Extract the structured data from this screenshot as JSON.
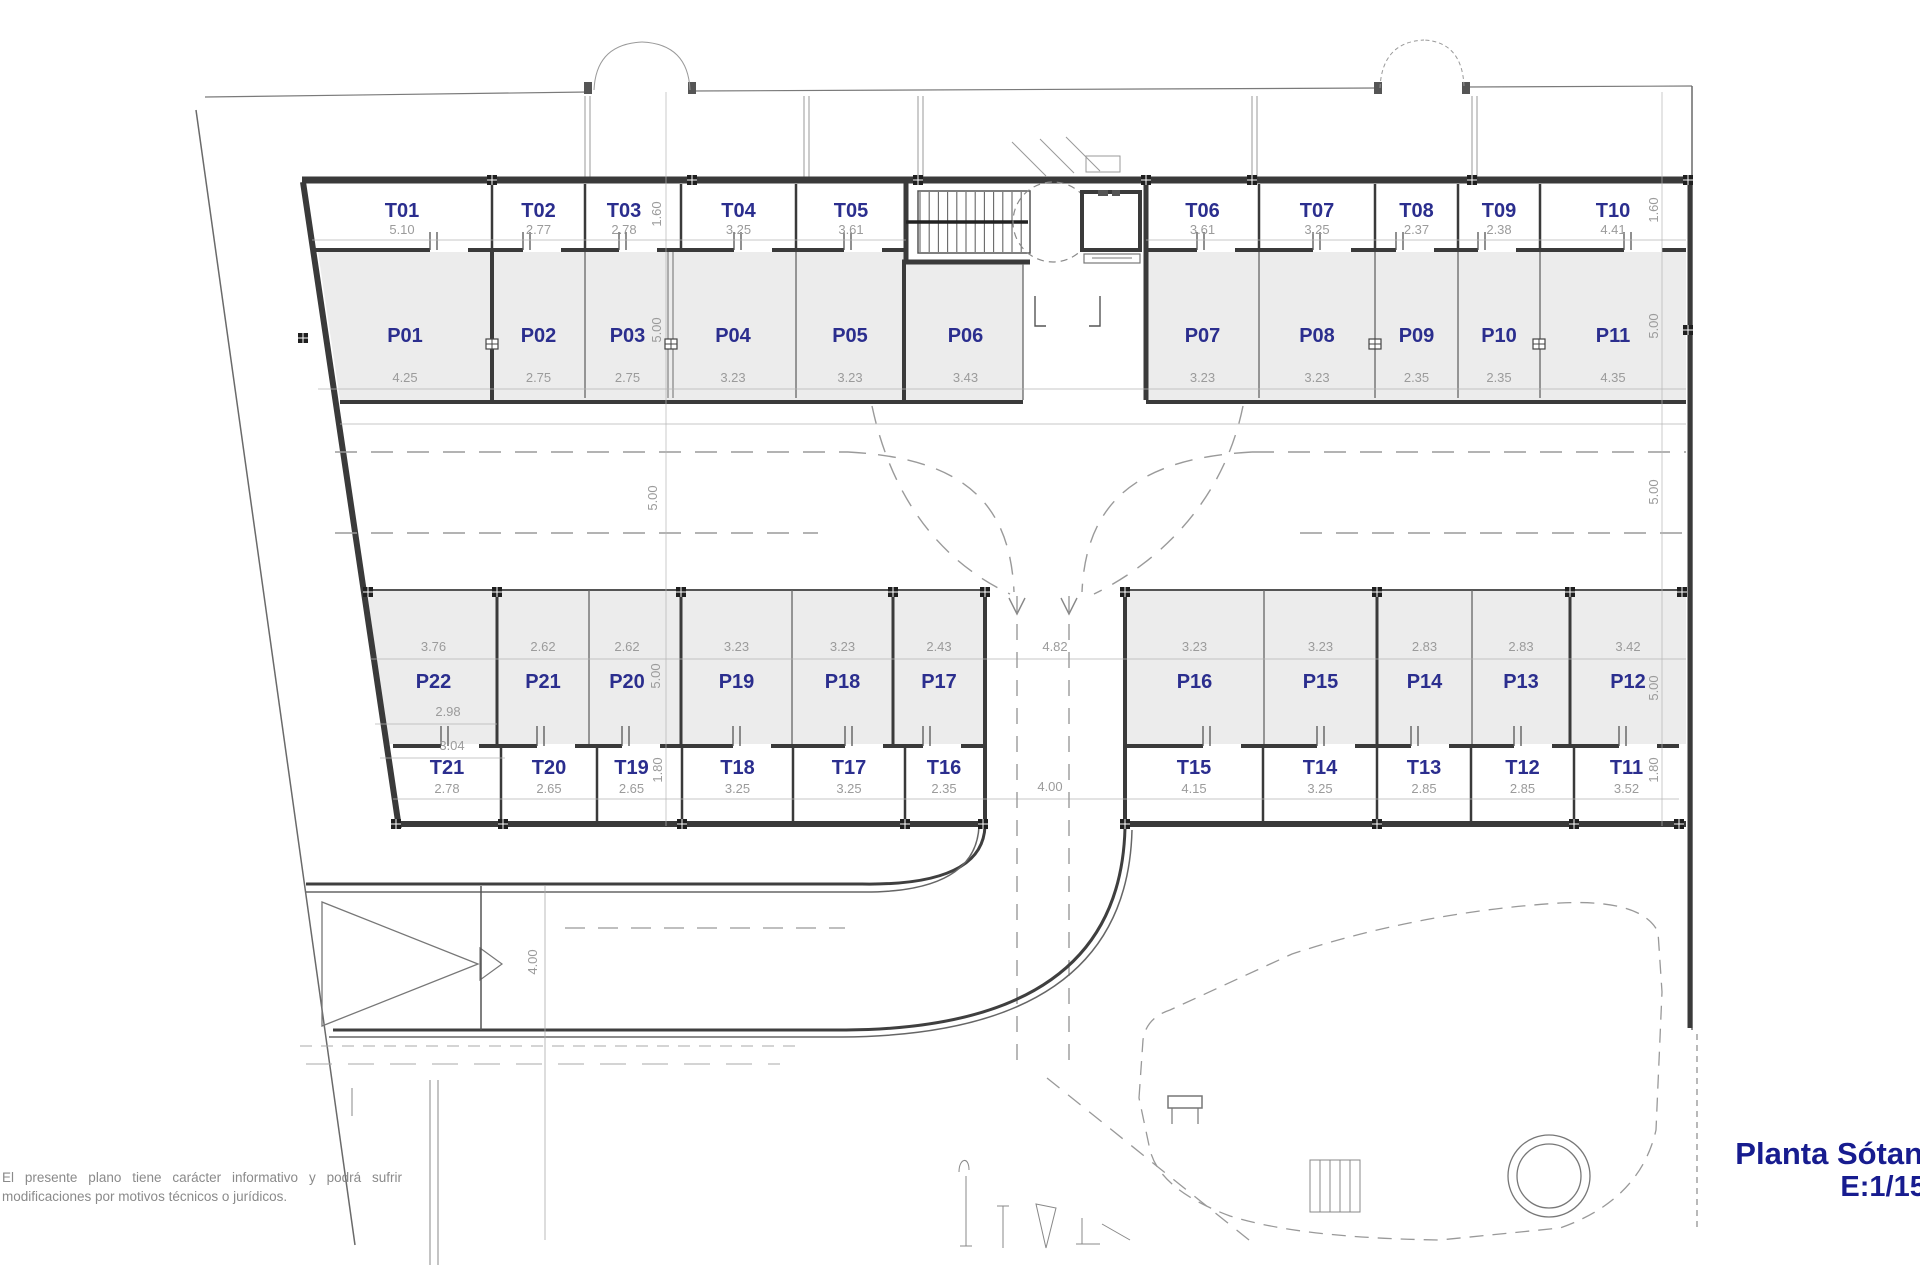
{
  "plan": {
    "title": {
      "name": "Planta Sótano",
      "scale": "E:1/150"
    },
    "disclaimer": [
      "El presente plano tiene carácter informativo y podrá sufrir",
      "modifica­ciones por motivos técnicos o jurídicos."
    ],
    "colors": {
      "room_label": "#2b2e8e",
      "dimension": "#9b9b9b",
      "title": "#171c8f",
      "wall": "#3a3a3a",
      "stall_fill": "#ececec"
    },
    "groups": {
      "storage_top": [
        {
          "label": "T01",
          "dim": "5.10"
        },
        {
          "label": "T02",
          "dim": "2.77"
        },
        {
          "label": "T03",
          "dim": "2.78"
        },
        {
          "label": "T04",
          "dim": "3.25"
        },
        {
          "label": "T05",
          "dim": "3.61"
        },
        {
          "label": "T06",
          "dim": "3.61"
        },
        {
          "label": "T07",
          "dim": "3.25"
        },
        {
          "label": "T08",
          "dim": "2.37"
        },
        {
          "label": "T09",
          "dim": "2.38"
        },
        {
          "label": "T10",
          "dim": "4.41"
        }
      ],
      "parking_top": [
        {
          "label": "P01",
          "dim": "4.25"
        },
        {
          "label": "P02",
          "dim": "2.75"
        },
        {
          "label": "P03",
          "dim": "2.75"
        },
        {
          "label": "P04",
          "dim": "3.23"
        },
        {
          "label": "P05",
          "dim": "3.23"
        },
        {
          "label": "P06",
          "dim": "3.43"
        },
        {
          "label": "P07",
          "dim": "3.23"
        },
        {
          "label": "P08",
          "dim": "3.23"
        },
        {
          "label": "P09",
          "dim": "2.35"
        },
        {
          "label": "P10",
          "dim": "2.35"
        },
        {
          "label": "P11",
          "dim": "4.35"
        }
      ],
      "parking_bottom_left": [
        {
          "label": "P22",
          "dim": "3.76",
          "extra_dims": [
            "2.98",
            "3.04"
          ]
        },
        {
          "label": "P21",
          "dim": "2.62"
        },
        {
          "label": "P20",
          "dim": "2.62"
        },
        {
          "label": "P19",
          "dim": "3.23"
        },
        {
          "label": "P18",
          "dim": "3.23"
        },
        {
          "label": "P17",
          "dim": "2.43"
        }
      ],
      "parking_bottom_right": [
        {
          "label": "P16",
          "dim": "3.23"
        },
        {
          "label": "P15",
          "dim": "3.23"
        },
        {
          "label": "P14",
          "dim": "2.83"
        },
        {
          "label": "P13",
          "dim": "2.83"
        },
        {
          "label": "P12",
          "dim": "3.42"
        }
      ],
      "storage_bottom_left": [
        {
          "label": "T21",
          "dim": "2.78"
        },
        {
          "label": "T20",
          "dim": "2.65"
        },
        {
          "label": "T19",
          "dim": "2.65"
        },
        {
          "label": "T18",
          "dim": "3.25"
        },
        {
          "label": "T17",
          "dim": "3.25"
        },
        {
          "label": "T16",
          "dim": "2.35"
        }
      ],
      "storage_bottom_right": [
        {
          "label": "T15",
          "dim": "4.15"
        },
        {
          "label": "T14",
          "dim": "3.25"
        },
        {
          "label": "T13",
          "dim": "2.85"
        },
        {
          "label": "T12",
          "dim": "2.85"
        },
        {
          "label": "T11",
          "dim": "3.52"
        }
      ]
    },
    "depth_dims": {
      "left": [
        "1.60",
        "5.00",
        "5.00",
        "5.00",
        "1.80"
      ],
      "right": [
        "1.60",
        "5.00",
        "5.00",
        "5.00",
        "1.80"
      ]
    },
    "ramp_dims": {
      "aisle_width": "4.82",
      "ramp_width": "4.00",
      "entry_width": "4.00"
    }
  }
}
